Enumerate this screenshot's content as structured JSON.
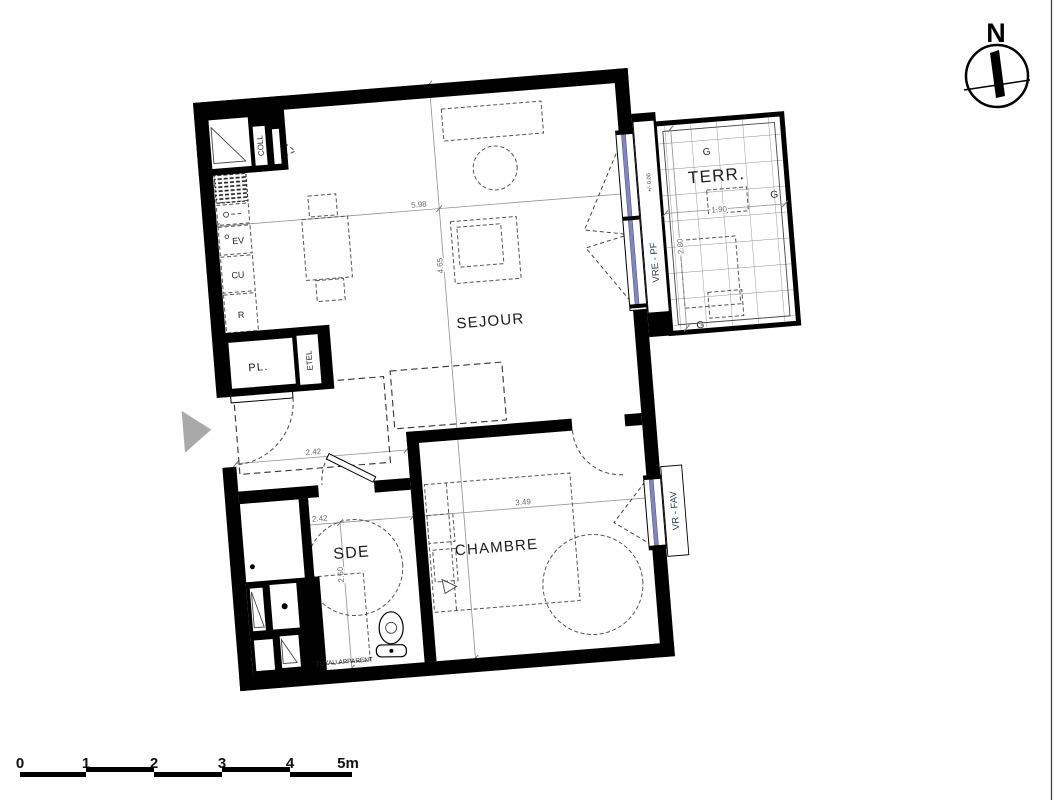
{
  "compass": {
    "north": "N"
  },
  "rooms": {
    "sejour": "SEJOUR",
    "chambre": "CHAMBRE",
    "sde": "SDE",
    "terrasse": "TERR.",
    "placard": "PL."
  },
  "kitchen": {
    "coll": "COLL",
    "ev": "EV",
    "cu": "CU",
    "r": "R",
    "etel": "ETEL"
  },
  "openings": {
    "level": "+/- 0.00",
    "vre_pf": "VRE - PF",
    "vr_fav": "VR - FAV"
  },
  "terrace": {
    "g_top": "G",
    "g_right": "G",
    "g_bottom": "G"
  },
  "notes": {
    "tuyau": "TUYAU APPARENT"
  },
  "dims": {
    "sejour_w": "5.98",
    "sejour_d": "4.65",
    "entree_w": "2.42",
    "sde_w": "2.42",
    "sde_d": "2.60",
    "chambre_w": "3.49",
    "terr_w": "1.90",
    "terr_d": "2.80"
  },
  "scale": {
    "t0": "0",
    "t1": "1",
    "t2": "2",
    "t3": "3",
    "t4": "4",
    "t5": "5m"
  },
  "colors": {
    "wall": "#000000",
    "glazing": "#8085c8",
    "entry_arrow": "#a9a9a9"
  }
}
